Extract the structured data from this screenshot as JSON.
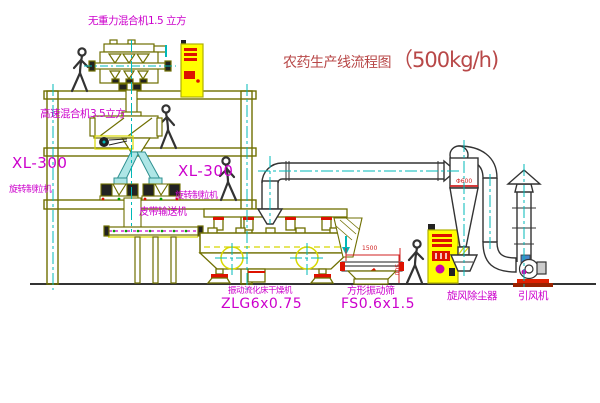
{
  "title": {
    "text": "农药生产线流程图",
    "capacity": "（500kg/h)"
  },
  "labels": {
    "top_mixer": "无重力混合机1.5 立方",
    "floor2_mixer": "高速混合机3.5立方",
    "granulator_left_model": "XL-300",
    "granulator_left_name": "旋转制粒机",
    "granulator_mid_model": "XL-300",
    "granulator_mid_name": "旋转制粒机",
    "belt_conveyor": "皮带输送机",
    "dryer_name": "振动流化床干燥机",
    "dryer_model": "ZLG6x0.75",
    "screen_name": "方形振动筛",
    "screen_model": "FS0.6x1.5",
    "cyclone_name": "旋风除尘器",
    "fan_name": "引风机"
  },
  "dimensions": {
    "screen_length": "1500",
    "screen_height": "500",
    "cyclone_diameter": "Φ600"
  },
  "colors": {
    "outline_olive": "#6f6f00",
    "pipe_dark": "#333333",
    "accent_cyan": "#00b8b8",
    "chute_fill": "#aee6e6",
    "label_magenta": "#cc00cc",
    "title_red": "#b84848",
    "dim_red": "#d02020",
    "cabinet_yellow": "#ffff00",
    "machine_red": "#dd1100"
  }
}
